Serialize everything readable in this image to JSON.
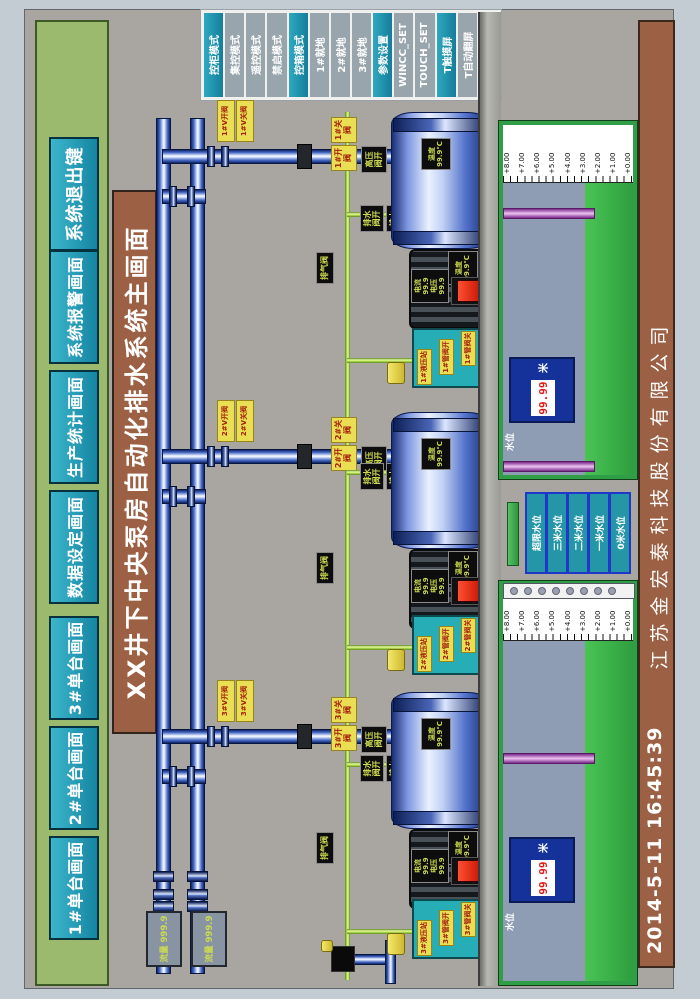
{
  "colors": {
    "teal_button": "#1f98b0",
    "title_brown": "#9c6144",
    "nav_green": "#9cba6e",
    "water_green": "#3cb44c",
    "pipe_blue": "#16307c",
    "tag_yellow": "#eadf52",
    "alarm_red": "#e01818"
  },
  "nav": {
    "buttons": [
      {
        "label": "1#单台画面"
      },
      {
        "label": "2#单台画面"
      },
      {
        "label": "3#单台画面"
      },
      {
        "label": "数据设定画面"
      },
      {
        "label": "生产统计画面"
      },
      {
        "label": "系统报警画面"
      }
    ],
    "exit_label": "系统退出键"
  },
  "title": {
    "text": "XX井下中央泵房自动化排水系统主画面"
  },
  "mode_panel": {
    "items": [
      {
        "label": "控柜模式",
        "active": true
      },
      {
        "label": "集控模式",
        "active": false
      },
      {
        "label": "遥控模式",
        "active": false
      },
      {
        "label": "禁启模式",
        "active": false
      },
      {
        "label": "控箱模式",
        "active": true
      },
      {
        "label": "1#就地",
        "active": false
      },
      {
        "label": "2#就地",
        "active": false
      },
      {
        "label": "3#就地",
        "active": false
      },
      {
        "label": "参数设置",
        "active": true
      },
      {
        "label": "WINCC_SET",
        "active": false
      },
      {
        "label": "TOUCH_SET",
        "active": false
      },
      {
        "label": "T触摸屏",
        "active": true
      },
      {
        "label": "T自动翻屏",
        "active": false
      },
      {
        "label": "T手动翻屏",
        "active": false
      }
    ]
  },
  "flow_meters": [
    {
      "text": "流量 999.9"
    },
    {
      "text": "流量 999.9"
    }
  ],
  "pumps": [
    {
      "id": "1#",
      "valve_open": "1#V开阀",
      "valve_close": "1#V关阀",
      "valve2_open": "1#开阀",
      "valve2_close": "1#关阀",
      "riser_tag": "高压阀开",
      "drain_open": "排水阀开",
      "drain_close": "排水阀关",
      "vent_tag": "排气阀",
      "motor_rows": {
        "current": "电流 99.9",
        "voltage": "电压 99.9"
      },
      "motor_temp": {
        "label": "温度",
        "value": "99.9℃"
      },
      "pump_temp": {
        "label": "温度",
        "value": "99.9℃"
      },
      "hyd_tags": [
        "1#液压站",
        "1#管阀开",
        "1#管阀关"
      ]
    },
    {
      "id": "2#",
      "valve_open": "2#V开阀",
      "valve_close": "2#V关阀",
      "valve2_open": "2#开阀",
      "valve2_close": "2#关阀",
      "riser_tag": "高压阀开",
      "drain_open": "排水阀开",
      "drain_close": "排水阀关",
      "vent_tag": "排气阀",
      "motor_rows": {
        "current": "电流 99.9",
        "voltage": "电压 99.9"
      },
      "motor_temp": {
        "label": "温度",
        "value": "99.9℃"
      },
      "pump_temp": {
        "label": "温度",
        "value": "99.9℃"
      },
      "hyd_tags": [
        "2#液压站",
        "2#管阀开",
        "2#管阀关"
      ]
    },
    {
      "id": "3#",
      "valve_open": "3#V开阀",
      "valve_close": "3#V关阀",
      "valve2_open": "3#开阀",
      "valve2_close": "3#关阀",
      "riser_tag": "高压阀开",
      "drain_open": "排水阀开",
      "drain_close": "排水阀关",
      "vent_tag": "排气阀",
      "motor_rows": {
        "current": "电流 99.9",
        "voltage": "电压 99.9"
      },
      "motor_temp": {
        "label": "温度",
        "value": "99.9℃"
      },
      "pump_temp": {
        "label": "温度",
        "value": "99.9℃"
      },
      "hyd_tags": [
        "3#液压站",
        "3#管阀开",
        "3#管阀关"
      ]
    }
  ],
  "tanks": [
    {
      "scale": [
        "+8.00",
        "+7.00",
        "+6.00",
        "+5.00",
        "+4.00",
        "+3.00",
        "+2.00",
        "+1.00",
        "+0.00"
      ],
      "level_label": "水位",
      "level_value": "99.99",
      "unit": "米"
    },
    {
      "scale": [
        "+8.00",
        "+7.00",
        "+6.00",
        "+5.00",
        "+4.00",
        "+3.00",
        "+2.00",
        "+1.00",
        "+0.00"
      ],
      "level_label": "水位",
      "level_value": "99.99",
      "unit": "米"
    }
  ],
  "level_markers": [
    "超限水位",
    "三米水位",
    "二米水位",
    "一米水位",
    "0米水位"
  ],
  "footer": {
    "datetime": "2014-5-11  16:45:39",
    "company": "江苏金宏泰科技股份有限公司"
  }
}
